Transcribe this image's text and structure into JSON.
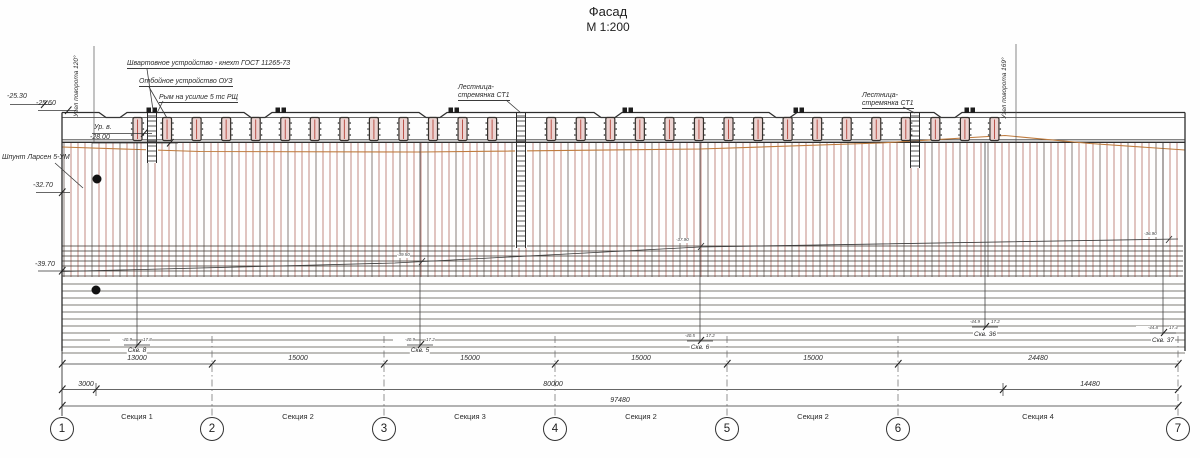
{
  "title": {
    "name": "Фасад",
    "scale": "М 1:200"
  },
  "callouts": {
    "mooring": "Швартовное устройство - кнехт ГОСТ 11265-73",
    "fender": "Отбойное устройство ОУЗ",
    "rym": "Рым на усилие 5 тс РЩ",
    "ladder_mid_line1": "Лестница-",
    "ladder_mid_line2": "стремянка СТ1",
    "ladder_right_line1": "Лестница-",
    "ladder_right_line2": "стремянка СТ1",
    "bend_left": "Узел поворота 120°",
    "bend_right": "Узел поворота 169°",
    "sheet_pile": "Шпунт Ларсен 5-УМ",
    "water_level": "Ур. в."
  },
  "elevations": {
    "top_left_outer": "-25.30",
    "top_left_cap": "-25.60",
    "water": "-28.00",
    "mid_left": "-32.70",
    "pile_tip_left": "-39.70"
  },
  "tip_marks": [
    {
      "value": "-39.50",
      "x": 397,
      "y": 253
    },
    {
      "value": "-37.90",
      "x": 676,
      "y": 238
    },
    {
      "value": "-36.90",
      "x": 1144,
      "y": 232
    }
  ],
  "boreholes": [
    {
      "name": "Скв. 8",
      "elev": "-40.9",
      "depth": "17.8",
      "x": 137,
      "flag_y": 345,
      "label_y": 348
    },
    {
      "name": "Скв. 5",
      "elev": "-40.9",
      "depth": "17.2",
      "x": 420,
      "flag_y": 345,
      "label_y": 348
    },
    {
      "name": "Скв. 6",
      "elev": "-40.5",
      "depth": "17.2",
      "x": 700,
      "flag_y": 341,
      "label_y": 345
    },
    {
      "name": "Скв. 36",
      "elev": "-44.9",
      "depth": "17.2",
      "x": 985,
      "flag_y": 327,
      "label_y": 332
    },
    {
      "name": "Скв. 37",
      "elev": "-44.8",
      "depth": "17.4",
      "x": 1163,
      "flag_y": 333,
      "label_y": 338
    }
  ],
  "dimensions": {
    "row1": [
      {
        "value": "13000",
        "cx": 137
      },
      {
        "value": "15000",
        "cx": 298
      },
      {
        "value": "15000",
        "cx": 470
      },
      {
        "value": "15000",
        "cx": 641
      },
      {
        "value": "15000",
        "cx": 813
      },
      {
        "value": "24480",
        "cx": 1038
      }
    ],
    "row2": [
      {
        "value": "3000",
        "cx": 86
      },
      {
        "value": "80000",
        "cx": 553
      },
      {
        "value": "14480",
        "cx": 1090
      }
    ],
    "row3": [
      {
        "value": "97480",
        "cx": 620
      }
    ]
  },
  "sections": [
    {
      "label": "Секция 1",
      "cx": 137
    },
    {
      "label": "Секция 2",
      "cx": 298
    },
    {
      "label": "Секция 3",
      "cx": 470
    },
    {
      "label": "Секция 2",
      "cx": 641
    },
    {
      "label": "Секция 2",
      "cx": 813
    },
    {
      "label": "Секция 4",
      "cx": 1038
    }
  ],
  "grid": [
    {
      "label": "1",
      "x": 62
    },
    {
      "label": "2",
      "x": 212
    },
    {
      "label": "3",
      "x": 384
    },
    {
      "label": "4",
      "x": 555
    },
    {
      "label": "5",
      "x": 727
    },
    {
      "label": "6",
      "x": 898
    },
    {
      "label": "7",
      "x": 1178
    }
  ],
  "colors": {
    "line": "#3a3a3a",
    "pile_red": "#a85a4c",
    "pile_dark": "#564840",
    "ground": "#bf7b3d",
    "fender_fill": "#ecd4d2",
    "fender_line": "#b5443a"
  }
}
